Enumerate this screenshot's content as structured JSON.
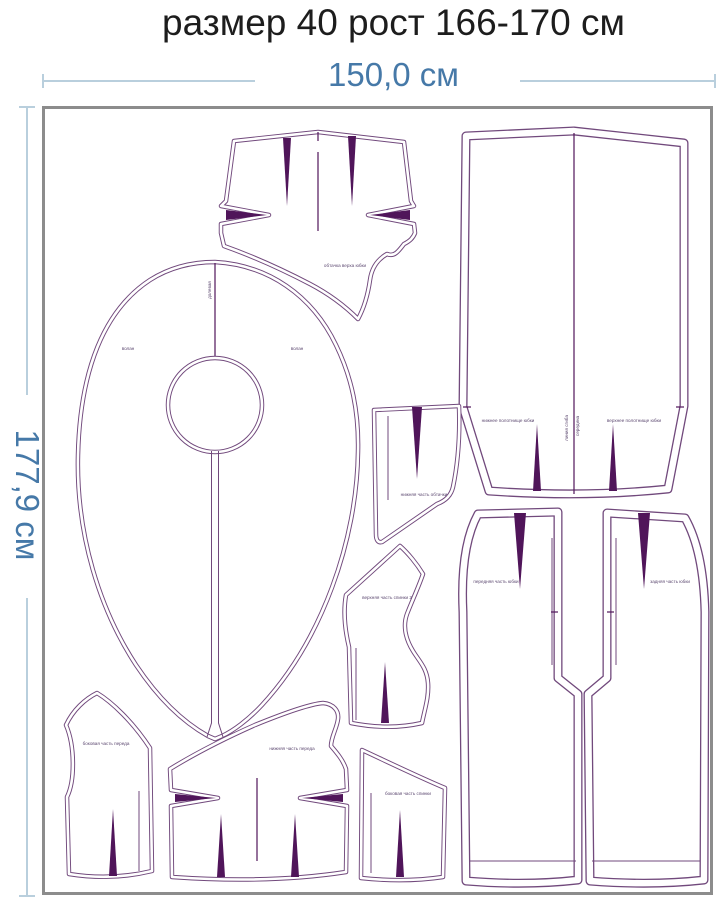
{
  "title": "размер 40 рост 166-170 см",
  "dimensions": {
    "width": "150,0 см",
    "height": "177,9 см"
  },
  "pieces": {
    "yoke": {
      "label": "обтачка верха юбки"
    },
    "flounce": {
      "label_left": "волан",
      "label_right": "волан",
      "grain": "долевая"
    },
    "fold_panel": {
      "label_left": "нижнее полотнище юбки",
      "label_right": "верхнее полотнище юбки",
      "fold_line_1": "линия сгиба",
      "fold_line_2": "середина"
    },
    "wedge": {
      "label": "нижняя часть обтачки"
    },
    "back_upper": {
      "label": "верхняя часть спинки 2"
    },
    "front_side": {
      "label": "боковая часть переда"
    },
    "front_lower": {
      "label": "нижняя часть переда"
    },
    "side_back": {
      "label": "боковая часть спинки"
    },
    "skirt_front": {
      "label": "передняя часть юбки"
    },
    "skirt_back": {
      "label": "задняя часть юбки"
    }
  },
  "colors": {
    "outline": "#71497c",
    "dart": "#50155a",
    "dimension_text": "#4679a8",
    "dimension_line": "#b9cfdd",
    "fabric_border": "#8c8c8c",
    "title_text": "#1d1d1d"
  }
}
